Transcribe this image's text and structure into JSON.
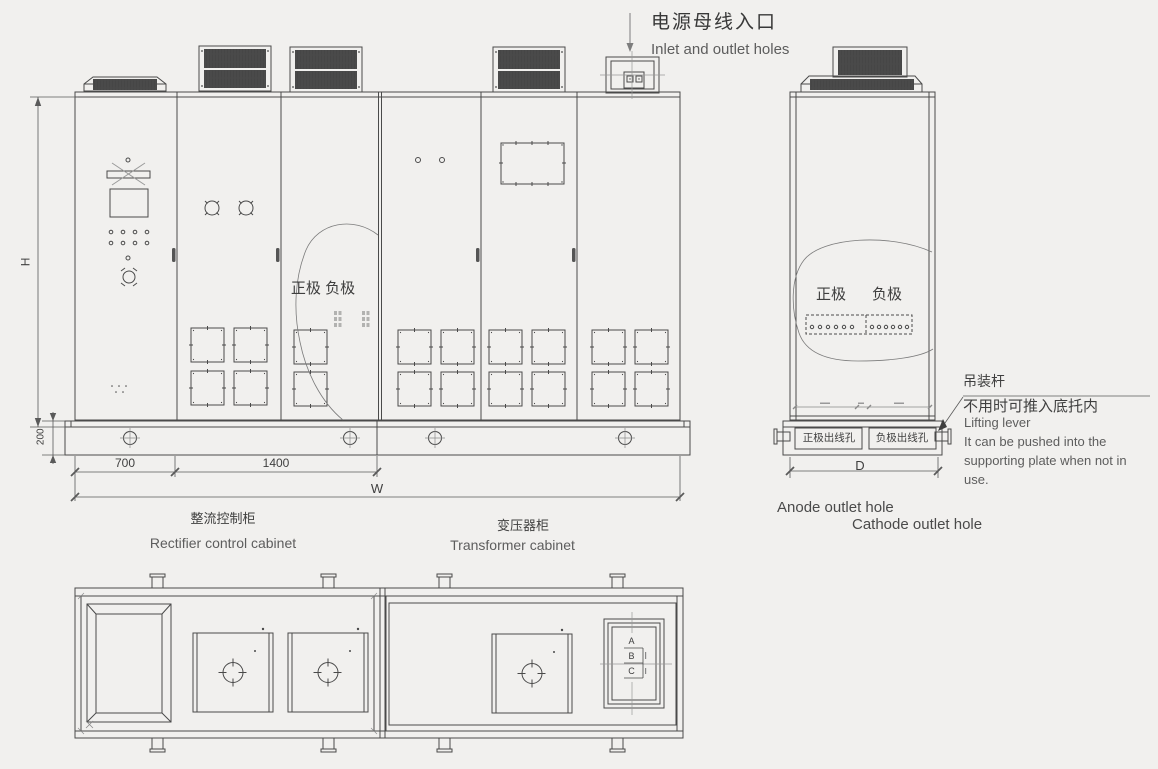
{
  "colors": {
    "background": "#f1f0ee",
    "line": "#4a4a4a",
    "thin_line": "#8a8a8a",
    "grille_dark": "#454545",
    "text_primary": "#3f3f3f",
    "text_secondary": "#5d5d5d"
  },
  "annotations": {
    "power_inlet_cn": "电源母线入口",
    "power_inlet_en": "Inlet and outlet holes",
    "front_polarity": "正极 负极",
    "side_polarity_positive": "正极",
    "side_polarity_negative": "负极",
    "anode_hole_cn": "正极出线孔",
    "cathode_hole_cn": "负极出线孔",
    "anode_outlet_en": "Anode outlet hole",
    "cathode_outlet_en": "Cathode outlet hole",
    "lifting_lever_cn": "吊装杆",
    "lifting_lever_note_cn": "不用时可推入底托内",
    "lifting_lever_en": "Lifting lever",
    "lifting_lever_note_en_lines": [
      "It can be pushed into the",
      "supporting plate when not in",
      "use."
    ]
  },
  "dimensions": {
    "height": "H",
    "base_height": "200",
    "segment_1": "700",
    "segment_2": "1400",
    "total_width": "W",
    "depth": "D"
  },
  "cabinets": {
    "rectifier_cn": "整流控制柜",
    "rectifier_en": "Rectifier control cabinet",
    "transformer_cn": "变压器柜",
    "transformer_en": "Transformer cabinet"
  },
  "phases": [
    "A",
    "B",
    "C"
  ]
}
